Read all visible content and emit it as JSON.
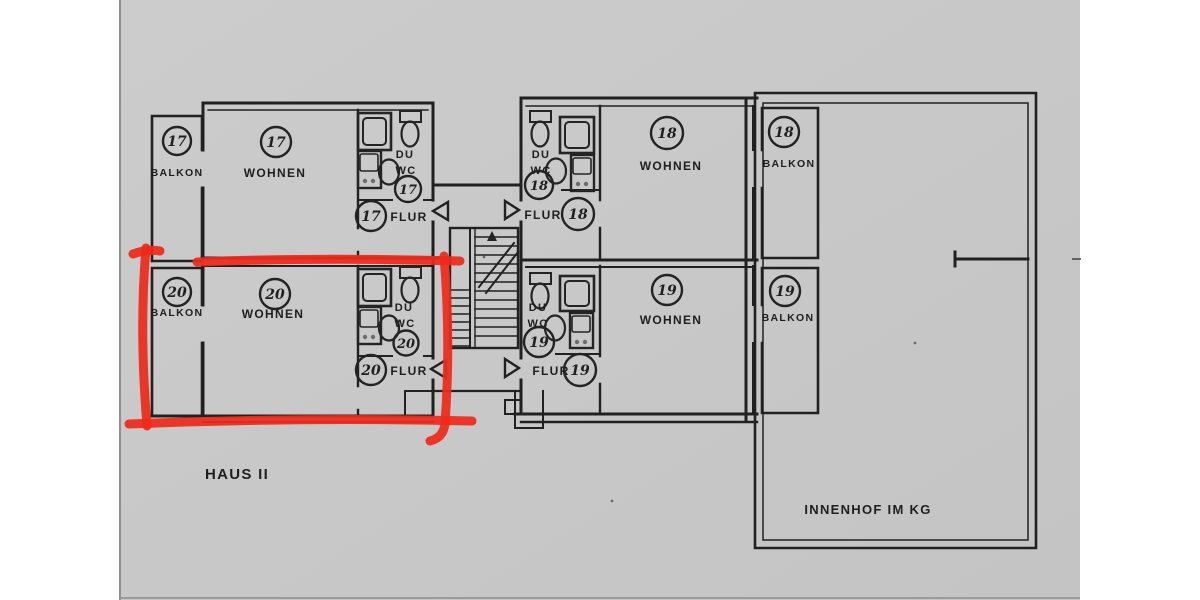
{
  "document": {
    "kind": "scanned floor plan",
    "haus_label": "HAUS II",
    "courtyard_label": "INNENHOF IM KG"
  },
  "colors": {
    "paper": "#c9c9c9",
    "margin": "#ffffff",
    "ink": "#212121",
    "annotation_red": "#ee2a1a"
  },
  "room_labels": {
    "balkon": "BALKON",
    "wohnen": "WOHNEN",
    "du": "DU",
    "wc": "WC",
    "flur": "FLUR"
  },
  "apartments": [
    {
      "number": "17",
      "position": "top-left",
      "highlighted": false
    },
    {
      "number": "18",
      "position": "top-right",
      "highlighted": false
    },
    {
      "number": "19",
      "position": "bottom-right",
      "highlighted": false
    },
    {
      "number": "20",
      "position": "bottom-left",
      "highlighted": true
    }
  ],
  "annotation": {
    "shape": "hand-drawn marker rectangle",
    "marks_apartment": "20",
    "color": "#ee2a1a"
  }
}
